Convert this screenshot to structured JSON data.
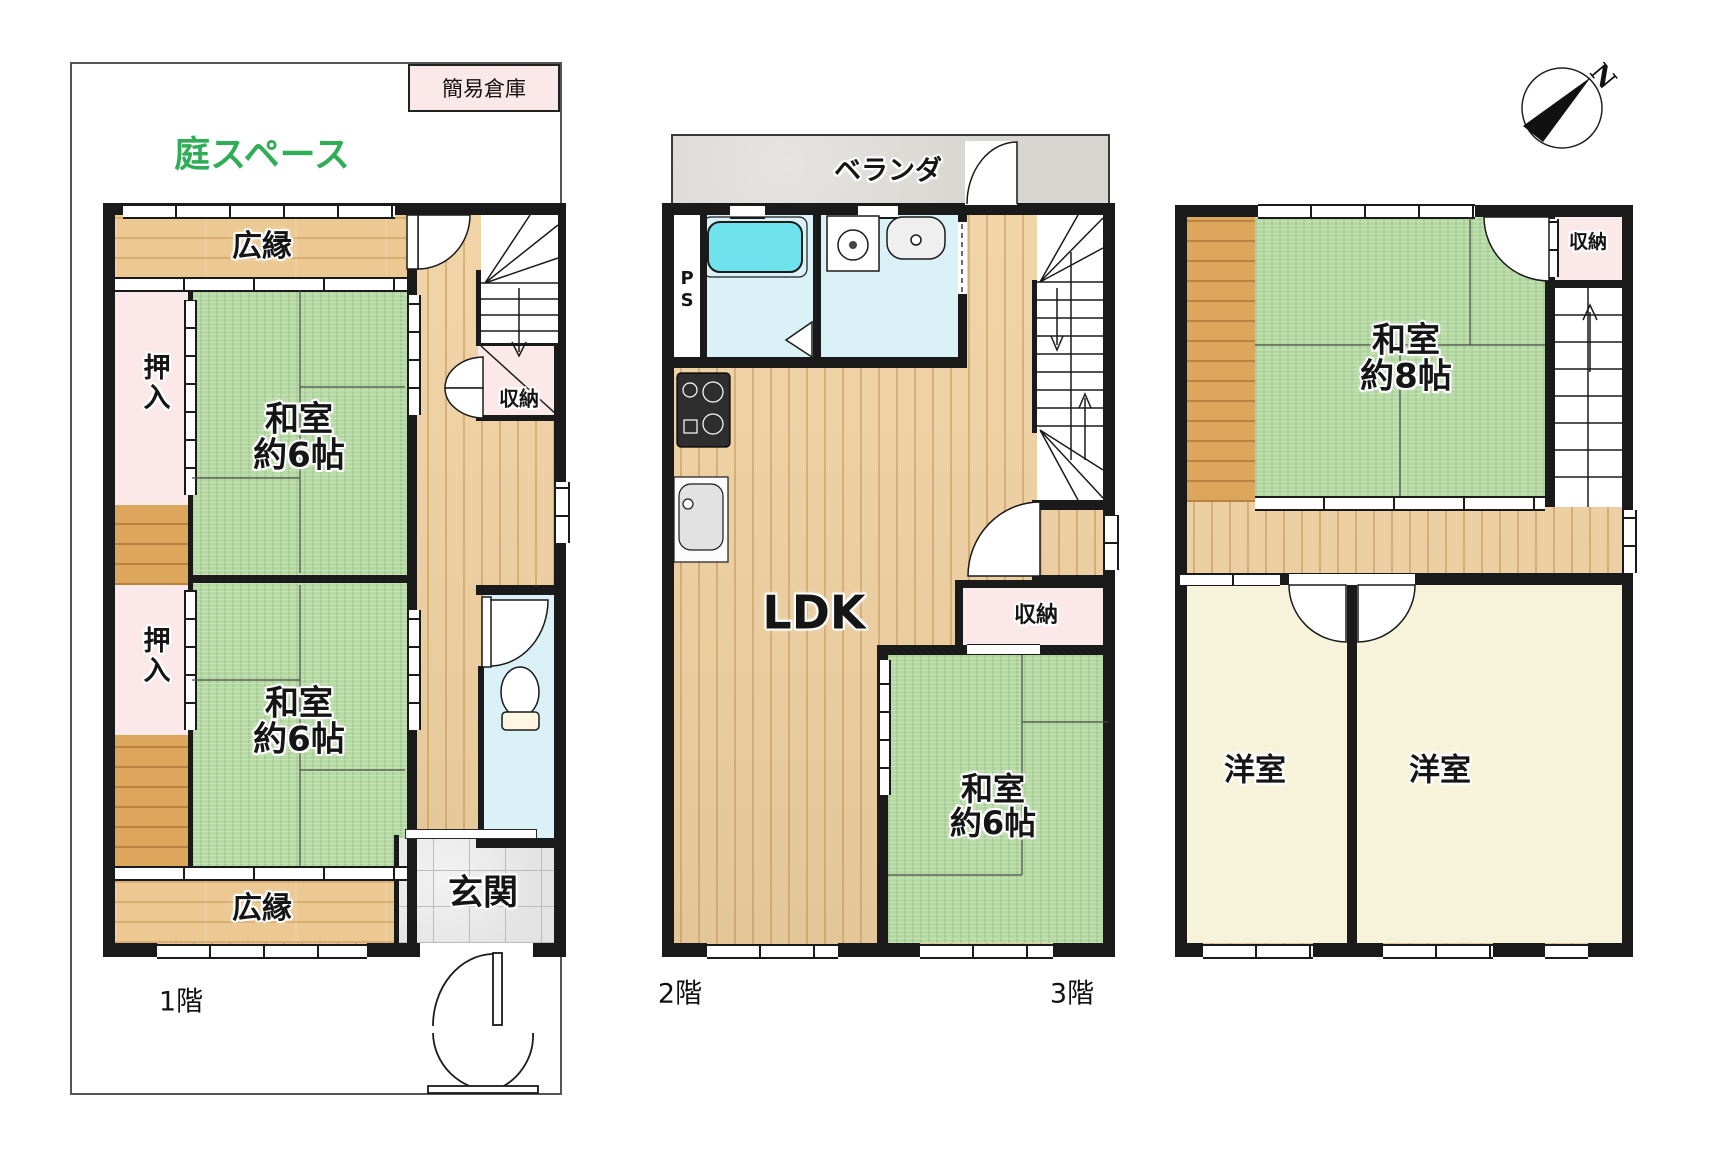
{
  "title": "間取り図（3階建て住宅 floor plan）",
  "colors": {
    "tatami_green": "#b5d9a3",
    "wood_floor": "#f0d1a0",
    "dark_wood": "#dca65c",
    "closet_pink": "#fbe8e8",
    "wet_area_cyan": "#daf1f7",
    "bathtub_cyan": "#6fe3ed",
    "western_room_cream": "#f7f3da",
    "balcony_gray": "#d8d6d1",
    "entrance_tile_gray": "#e3e3e3",
    "wall_black": "#1a1a1a",
    "garden_text_green": "#2fae57"
  },
  "compass": {
    "north_label": "N"
  },
  "floor1": {
    "caption": "1階",
    "garden_label": "庭スペース",
    "shed_label": "簡易倉庫",
    "hiroen_top": "広縁",
    "hiroen_bottom": "広縁",
    "oshiire_top": "押入",
    "oshiire_bottom": "押入",
    "washitsu_top": {
      "line1": "和室",
      "line2": "約6帖"
    },
    "washitsu_bottom": {
      "line1": "和室",
      "line2": "約6帖"
    },
    "shuno": "収納",
    "genkan": "玄関"
  },
  "floor2": {
    "caption": "2階",
    "veranda": "ベランダ",
    "ps": "PS",
    "ldk": "LDK",
    "shuno": "収納",
    "washitsu": {
      "line1": "和室",
      "line2": "約6帖"
    }
  },
  "floor3": {
    "caption": "3階",
    "washitsu": {
      "line1": "和室",
      "line2": "約8帖"
    },
    "shuno": "収納",
    "yoshitsu_left": "洋室",
    "yoshitsu_right": "洋室"
  }
}
